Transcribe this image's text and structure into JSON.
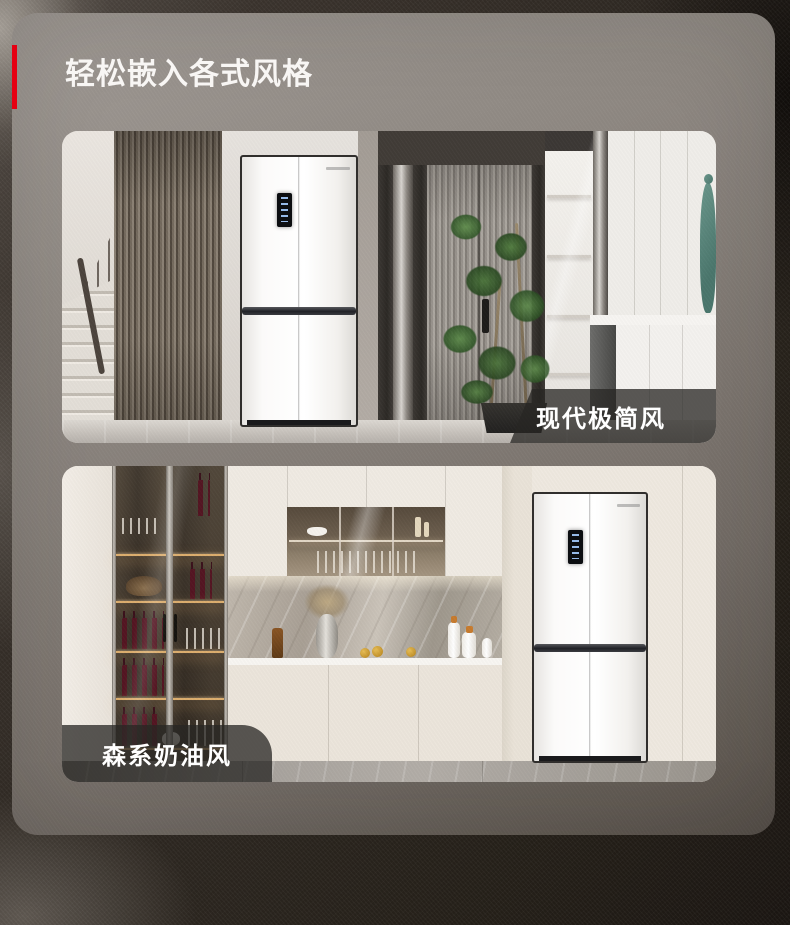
{
  "page": {
    "title": "轻松嵌入各式风格",
    "accent_color": "#e60012",
    "background_color": "#2f2923",
    "panel_top_color": "#a09a95",
    "panel_bottom_color": "#57504a",
    "bottom_strip_color": "#ffffff",
    "caption_overlay_color": "rgba(40,38,36,0.76)"
  },
  "sections": [
    {
      "label": "现代极简风",
      "label_corner": "bottom-right",
      "photo_alt": "modern-minimalist-hallway-with-built-in-white-four-door-refrigerator"
    },
    {
      "label": "森系奶油风",
      "label_corner": "bottom-left",
      "photo_alt": "cream-style-kitchen-with-wine-cabinet-and-built-in-white-four-door-refrigerator"
    }
  ]
}
